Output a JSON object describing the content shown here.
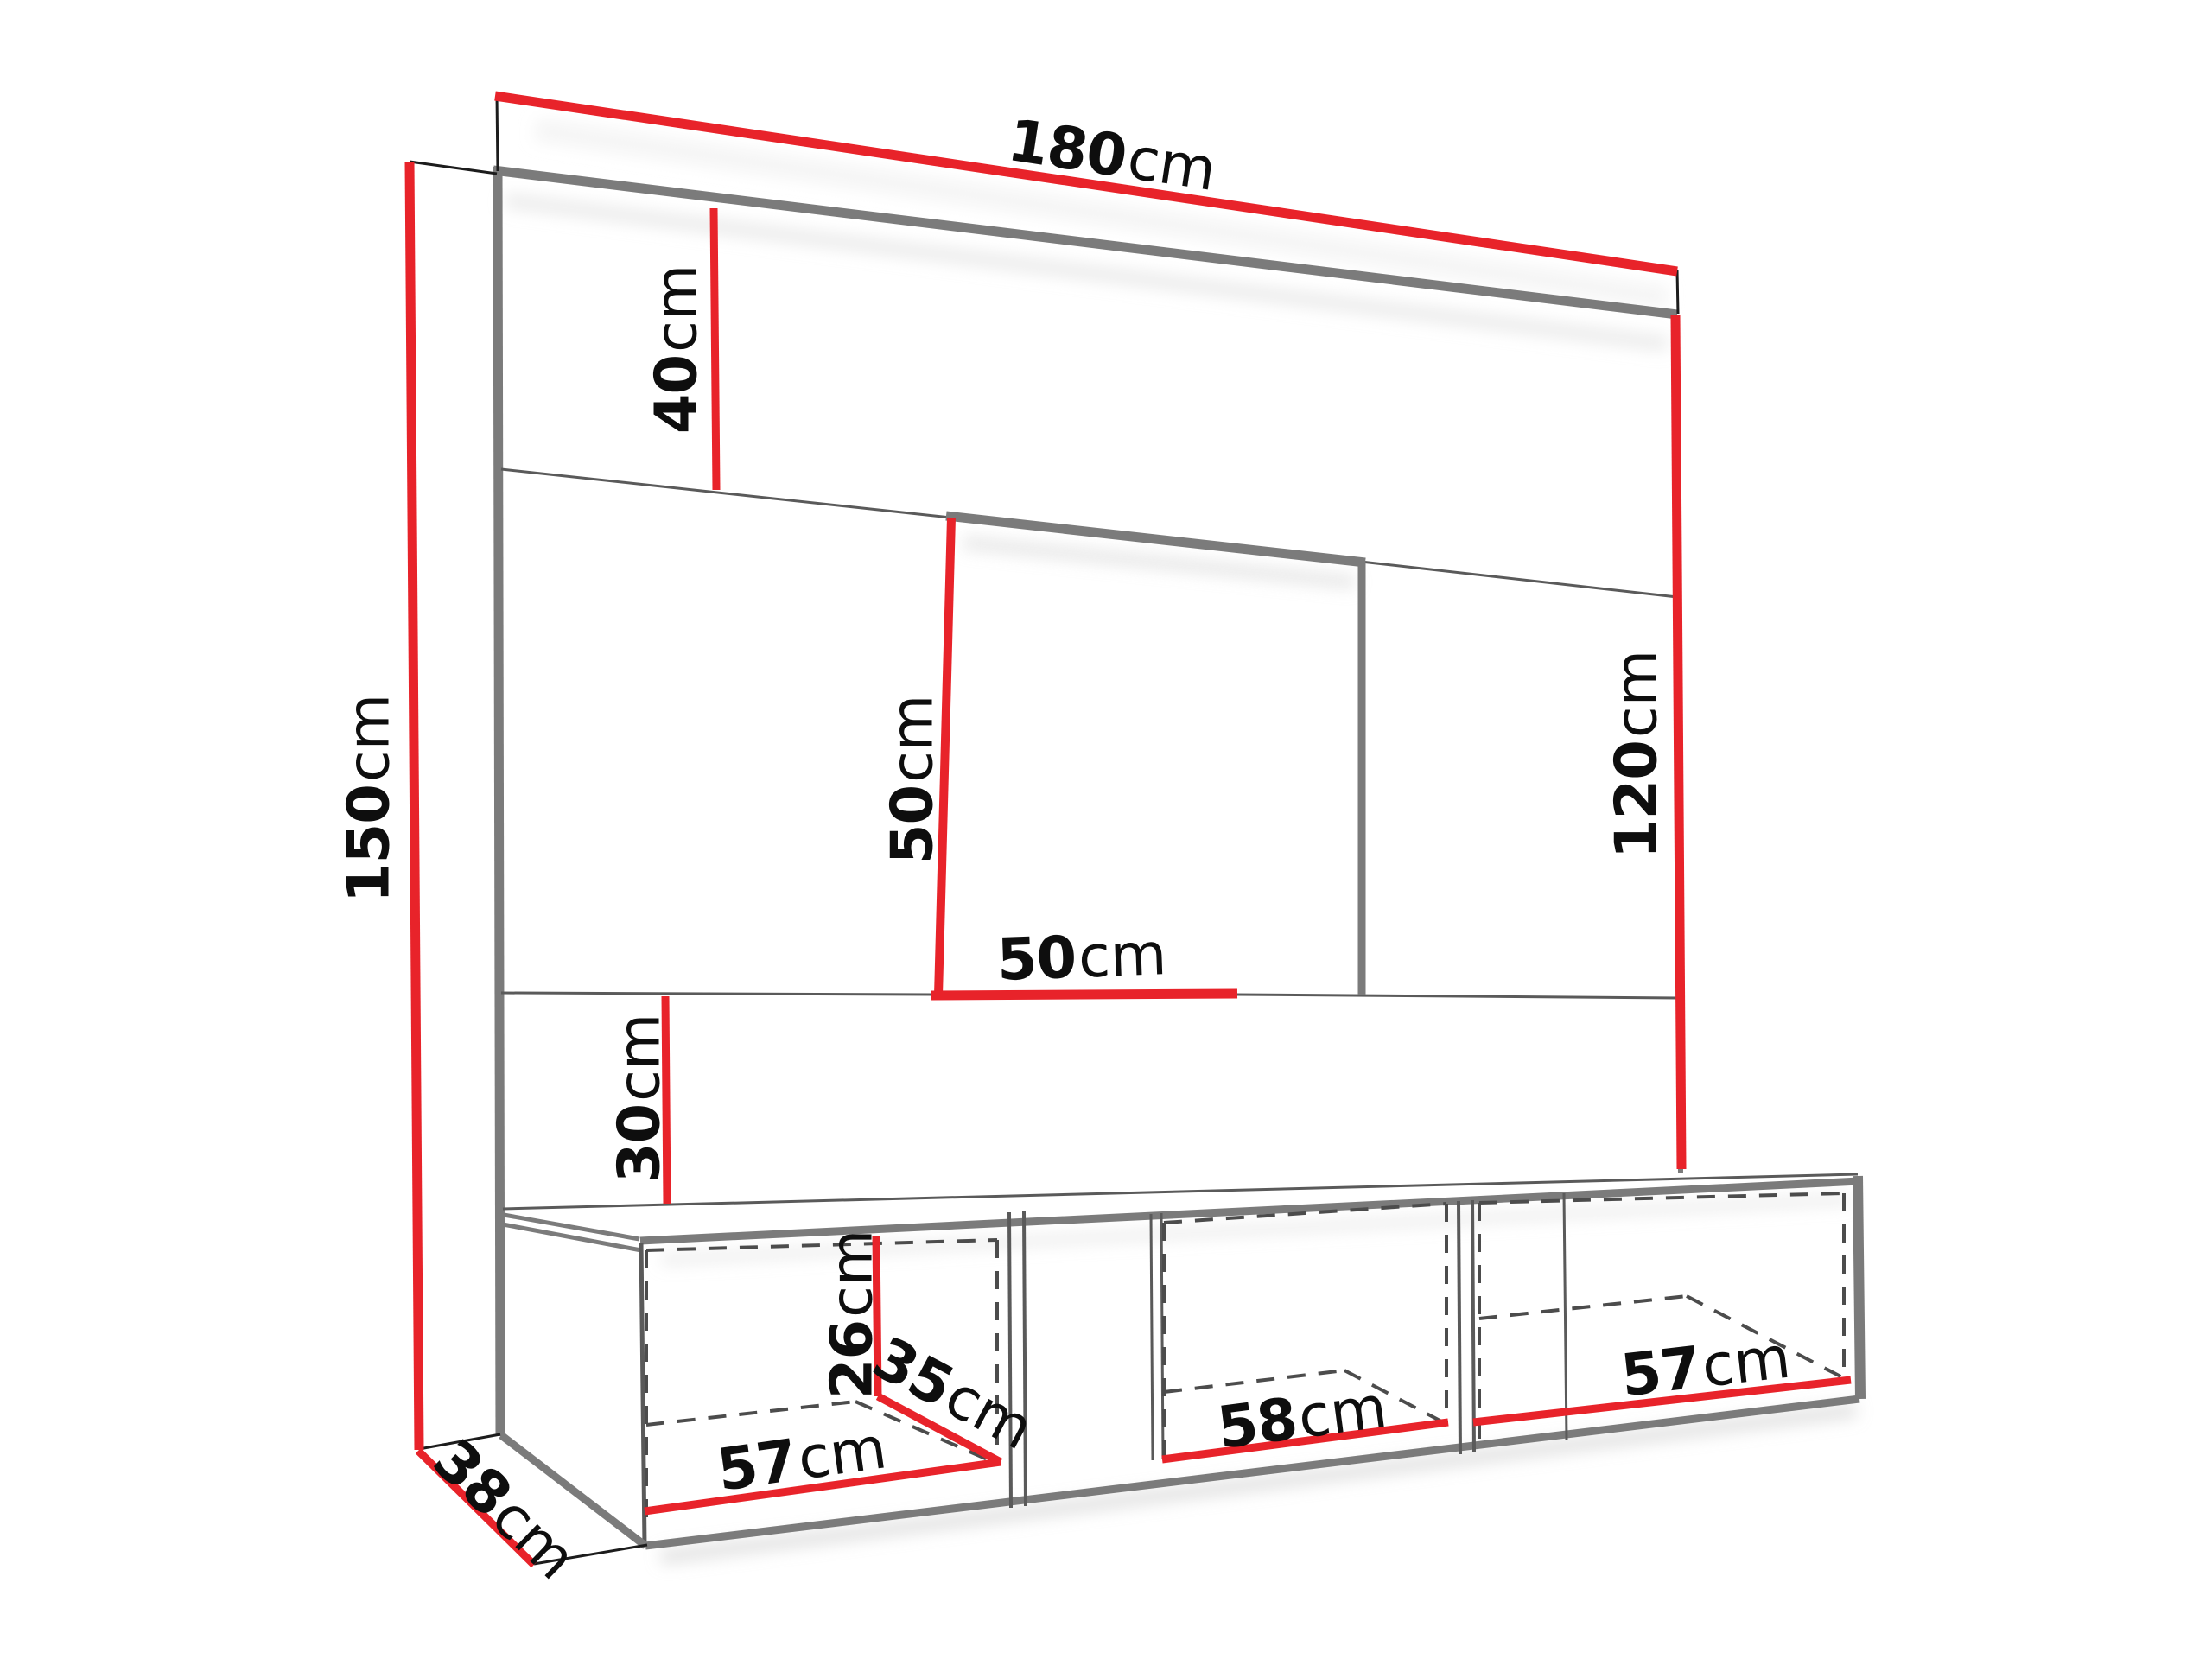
{
  "diagram": {
    "kind": "furniture-dimension-drawing",
    "subject": "wall-mounted TV entertainment unit with three-compartment floating cabinet",
    "units": "cm"
  },
  "style": {
    "accent_red": "#e8232a",
    "edge_gray": "#7b7b7b",
    "thin_gray": "#5a5a5a",
    "dash_gray": "#4c4c4c",
    "text_ink": "#0e0e0e",
    "background": "#ffffff"
  },
  "dims": {
    "w180": {
      "num": "180",
      "unit": "cm"
    },
    "h40": {
      "num": "40",
      "unit": "cm"
    },
    "h150": {
      "num": "150",
      "unit": "cm"
    },
    "niche_h50": {
      "num": "50",
      "unit": "cm"
    },
    "niche_w50": {
      "num": "50",
      "unit": "cm"
    },
    "h120": {
      "num": "120",
      "unit": "cm"
    },
    "h30": {
      "num": "30",
      "unit": "cm"
    },
    "cab_h26": {
      "num": "26",
      "unit": "cm"
    },
    "cab_d35": {
      "num": "35",
      "unit": "cm"
    },
    "comp_w57_left": {
      "num": "57",
      "unit": "cm"
    },
    "comp_w58_mid": {
      "num": "58",
      "unit": "cm"
    },
    "comp_w57_right": {
      "num": "57",
      "unit": "cm"
    },
    "base_d38": {
      "num": "38",
      "unit": "cm"
    }
  }
}
